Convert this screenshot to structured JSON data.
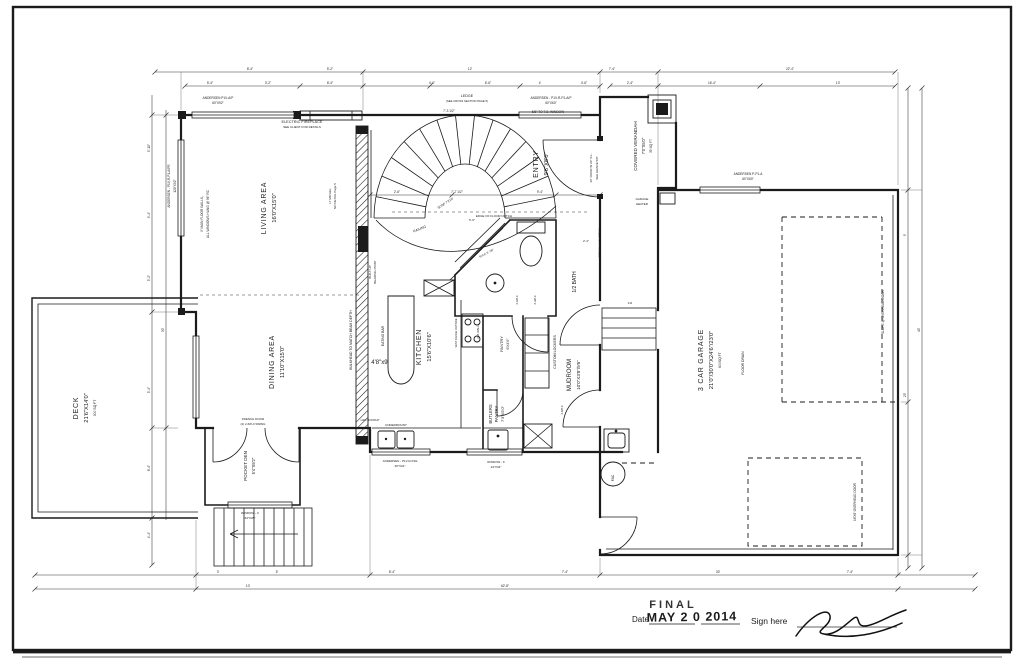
{
  "colors": {
    "ink": "#1b1b1b",
    "dim": "#333333",
    "paper": "#ffffff",
    "scan_shadow": "#b5b5b5"
  },
  "stamp": {
    "date_label": "Date",
    "final": "FINAL",
    "date_stamp": "MAY 2 0 2014",
    "sign_label": "Sign here"
  },
  "labels": [
    {
      "t": "LIVING AREA",
      "x": 266,
      "y": 208,
      "r": -90,
      "s": 7,
      "ls": 0.8,
      "n": "label-living-area"
    },
    {
      "t": "16'0\"X15'0\"",
      "x": 276,
      "y": 208,
      "r": -90,
      "s": 5.8,
      "n": "label-living-area-dims"
    },
    {
      "t": "DINING AREA",
      "x": 274,
      "y": 362,
      "r": -90,
      "s": 7,
      "ls": 0.8,
      "n": "label-dining-area"
    },
    {
      "t": "11'10\"X15'0\"",
      "x": 284,
      "y": 362,
      "r": -90,
      "s": 5.8,
      "n": "label-dining-area-dims"
    },
    {
      "t": "KITCHEN",
      "x": 421,
      "y": 347,
      "r": -90,
      "s": 7,
      "ls": 0.8,
      "n": "label-kitchen"
    },
    {
      "t": "15'6\"X10'6\"",
      "x": 431,
      "y": 347,
      "r": -90,
      "s": 5.8,
      "n": "label-kitchen-dims"
    },
    {
      "t": "ENTRY",
      "x": 538,
      "y": 164,
      "r": -90,
      "s": 7,
      "ls": 0.8,
      "n": "label-entry"
    },
    {
      "t": "9'6\"X8'0\"",
      "x": 548,
      "y": 164,
      "r": -90,
      "s": 5.8,
      "n": "label-entry-dims"
    },
    {
      "t": "DECK",
      "x": 78,
      "y": 408,
      "r": -90,
      "s": 7,
      "ls": 0.8,
      "n": "label-deck"
    },
    {
      "t": "21'6\"X14'0\"",
      "x": 88,
      "y": 408,
      "r": -90,
      "s": 5.8,
      "n": "label-deck-dims"
    },
    {
      "t": "300 SQ FT",
      "x": 96,
      "y": 408,
      "r": -90,
      "s": 3.4,
      "n": "label-deck-area"
    },
    {
      "t": "POCKET DEN",
      "x": 247,
      "y": 466,
      "r": -90,
      "s": 4.6,
      "n": "label-pocket-den"
    },
    {
      "t": "5'4\"X9'2\"",
      "x": 255,
      "y": 466,
      "r": -90,
      "s": 4.2,
      "n": "label-pocket-den-dims"
    },
    {
      "t": "3 CAR GARAGE",
      "x": 703,
      "y": 360,
      "r": -90,
      "s": 7,
      "ls": 0.8,
      "n": "label-garage"
    },
    {
      "t": "21'0\"/30'0\"X24'6\"/23'0\"",
      "x": 713,
      "y": 360,
      "r": -90,
      "s": 5.8,
      "n": "label-garage-dims"
    },
    {
      "t": "600SQ FT",
      "x": 721,
      "y": 360,
      "r": -90,
      "s": 3.4,
      "n": "label-garage-area"
    },
    {
      "t": "MUDROOM",
      "x": 571,
      "y": 375,
      "r": -90,
      "s": 6,
      "n": "label-mudroom"
    },
    {
      "t": "10'0\"X3'8\"/5'6\"",
      "x": 580,
      "y": 375,
      "r": -90,
      "s": 4.6,
      "n": "label-mudroom-dims"
    },
    {
      "t": "BUTLERS",
      "x": 492,
      "y": 414,
      "r": -90,
      "s": 4.2,
      "n": "label-butlers-pantry"
    },
    {
      "t": "PANTRY",
      "x": 498,
      "y": 414,
      "r": -90,
      "s": 4.2,
      "n": "label-butlers-pantry-2"
    },
    {
      "t": "7'3\"X5'0\"",
      "x": 504,
      "y": 414,
      "r": -90,
      "s": 4,
      "n": "label-butlers-pantry-dims"
    },
    {
      "t": "1/2 BATH",
      "x": 576,
      "y": 282,
      "r": -90,
      "s": 5,
      "n": "label-half-bath"
    },
    {
      "t": "COVERED VERANDAH",
      "x": 637,
      "y": 146,
      "r": -90,
      "s": 4.6,
      "n": "label-verandah"
    },
    {
      "t": "7'0\"X5'0\"",
      "x": 645,
      "y": 146,
      "r": -90,
      "s": 4.2,
      "n": "label-verandah-dims"
    },
    {
      "t": "35 SQ FT",
      "x": 652,
      "y": 146,
      "r": -90,
      "s": 3.2,
      "n": "label-verandah-area"
    },
    {
      "t": "PANTRY",
      "x": 503,
      "y": 344,
      "r": -90,
      "s": 4,
      "n": "label-pantry"
    },
    {
      "t": "6'X4'0\"",
      "x": 509,
      "y": 344,
      "r": -90,
      "s": 3.6,
      "n": "label-pantry-dims"
    },
    {
      "t": "CUSTOM LOCKERS",
      "x": 556,
      "y": 352,
      "r": -90,
      "s": 3.6,
      "n": "label-custom-lockers"
    },
    {
      "t": "EATING BAR",
      "x": 384,
      "y": 336,
      "r": -90,
      "s": 3.4,
      "n": "label-eating-bar"
    },
    {
      "t": "4'8\"x9'",
      "x": 380,
      "y": 364,
      "s": 6,
      "n": "label-island-dims"
    },
    {
      "t": "ELECTRIC FIREPLACE",
      "x": 302,
      "y": 123,
      "s": 3.8,
      "n": "note-electric-fireplace"
    },
    {
      "t": "SEE CLIENT FOR DETAILS",
      "x": 302,
      "y": 128,
      "s": 3,
      "n": "note-electric-fireplace-2"
    },
    {
      "t": "LEDGE",
      "x": 467,
      "y": 97,
      "s": 3.6,
      "n": "note-ledge"
    },
    {
      "t": "(SEE CROSS SECTION PAGE 5)",
      "x": 467,
      "y": 102,
      "s": 2.8,
      "n": "note-ledge-2"
    },
    {
      "t": "ANDERSEN P1V-A/P",
      "x": 218,
      "y": 99,
      "s": 3.2,
      "n": "note-window-living"
    },
    {
      "t": "60\"X92\"",
      "x": 218,
      "y": 104,
      "s": 3.2,
      "n": "note-window-living-2"
    },
    {
      "t": "ANDERSEN - P1V-R-P1-A/P",
      "x": 551,
      "y": 99,
      "s": 3.2,
      "n": "note-window-entry"
    },
    {
      "t": "60\"X60\"",
      "x": 551,
      "y": 104,
      "s": 3.2,
      "n": "note-window-entry-2"
    },
    {
      "t": "5/8\" TO T.O. WINDOW",
      "x": 548,
      "y": 113,
      "s": 3.2,
      "n": "note-window-head"
    },
    {
      "t": "ANDERSEN P-P1-A",
      "x": 748,
      "y": 175,
      "s": 3.2,
      "n": "note-window-garage"
    },
    {
      "t": "60\"X60\"",
      "x": 748,
      "y": 180,
      "s": 3.2,
      "n": "note-window-garage-2"
    },
    {
      "t": "ANDERSEN - P1V-R-P1-A/PR",
      "x": 170,
      "y": 186,
      "r": -90,
      "s": 3.2,
      "n": "note-window-left"
    },
    {
      "t": "120\"X92\"",
      "x": 176,
      "y": 186,
      "r": -90,
      "s": 3.2,
      "n": "note-window-left-2"
    },
    {
      "t": "9' MAIN FLOOR WALLS,",
      "x": 203,
      "y": 214,
      "r": -90,
      "s": 3.2,
      "n": "note-wall-height"
    },
    {
      "t": "ALL WINDOWS HUNG @ 96\" RC",
      "x": 209,
      "y": 214,
      "r": -90,
      "s": 3.2,
      "n": "note-wall-height-2"
    },
    {
      "t": "BULKHEAD TO MATCH BEAM DEPTH",
      "x": 352,
      "y": 340,
      "r": -90,
      "s": 3.4,
      "n": "note-bulkhead"
    },
    {
      "t": "LT MICHEL",
      "x": 331,
      "y": 196,
      "r": -90,
      "s": 3,
      "n": "note-lt-michel"
    },
    {
      "t": "NO DETAIL Page 5",
      "x": 336,
      "y": 196,
      "r": -90,
      "s": 3,
      "n": "note-lt-michel-2"
    },
    {
      "t": "BUILT-UP",
      "x": 371,
      "y": 272,
      "r": -90,
      "s": 3,
      "n": "note-bearing-point"
    },
    {
      "t": "BEARING POINT",
      "x": 376,
      "y": 272,
      "r": -90,
      "s": 3,
      "n": "note-bearing-point-2"
    },
    {
      "t": "EDGE OF FLOOR NOTCH",
      "x": 494,
      "y": 217,
      "s": 3,
      "n": "note-floor-notch"
    },
    {
      "t": "RAILING",
      "x": 420,
      "y": 230,
      "r": -22,
      "s": 3.4,
      "n": "note-railing"
    },
    {
      "t": "SUSP 7'X10'",
      "x": 446,
      "y": 204,
      "r": -33,
      "s": 3.2,
      "n": "note-susp"
    },
    {
      "t": "13\"WALL LVL BEAM",
      "x": 601,
      "y": 243,
      "r": -90,
      "s": 3.2,
      "n": "note-lvl-beam"
    },
    {
      "t": "36\" DOOR W 20\" S.L.",
      "x": 592,
      "y": 168,
      "r": -90,
      "s": 3,
      "n": "note-front-door"
    },
    {
      "t": "SEE GRADE 5/8\"",
      "x": 598,
      "y": 168,
      "r": -90,
      "s": 3,
      "n": "note-front-door-2"
    },
    {
      "t": "GARAGE",
      "x": 642,
      "y": 200,
      "s": 3,
      "n": "note-garage-heater"
    },
    {
      "t": "HEATER",
      "x": 642,
      "y": 205,
      "s": 3,
      "n": "note-garage-heater-2"
    },
    {
      "t": "FLOOR DRAIN",
      "x": 744,
      "y": 363,
      "r": -90,
      "s": 3.4,
      "n": "note-floor-drain"
    },
    {
      "t": "SLOPE @ OVERHEAD DOOR",
      "x": 884,
      "y": 312,
      "r": -90,
      "s": 3.2,
      "n": "note-slope-ohd"
    },
    {
      "t": "16'X8' OVERHEAD DOOR",
      "x": 856,
      "y": 502,
      "r": -90,
      "s": 3.2,
      "n": "note-overhead-door"
    },
    {
      "t": "FRENCH DOOR",
      "x": 253,
      "y": 420,
      "s": 3,
      "n": "note-french-door"
    },
    {
      "t": "(2) 2-6/8-0 SWING",
      "x": 253,
      "y": 425,
      "s": 3,
      "n": "note-french-door-2"
    },
    {
      "t": "WINDOW - C",
      "x": 250,
      "y": 514,
      "s": 3,
      "n": "note-window-c"
    },
    {
      "t": "64\"X28\"",
      "x": 250,
      "y": 519,
      "s": 3,
      "n": "note-window-c-2"
    },
    {
      "t": "WINDOW - K",
      "x": 496,
      "y": 463,
      "s": 3,
      "n": "note-window-k"
    },
    {
      "t": "24\"X34\"",
      "x": 496,
      "y": 468,
      "s": 3,
      "n": "note-window-k-2"
    },
    {
      "t": "ANDERSEN - P1V-R-P1E",
      "x": 400,
      "y": 462,
      "s": 3,
      "n": "note-window-kitchen"
    },
    {
      "t": "60\"X24\"",
      "x": 400,
      "y": 467,
      "s": 3,
      "n": "note-window-kitchen-2"
    },
    {
      "t": "UNDERMOUNT",
      "x": 396,
      "y": 426,
      "s": 3,
      "n": "note-undermount"
    },
    {
      "t": "H2O HOOKUP",
      "x": 370,
      "y": 421,
      "s": 2.8,
      "n": "note-h2o"
    },
    {
      "t": "FAC",
      "x": 614,
      "y": 478,
      "r": -90,
      "s": 3.4,
      "n": "note-fac"
    },
    {
      "t": "2X6 WALL",
      "x": 479,
      "y": 332,
      "r": -90,
      "s": 2.8,
      "n": "note-2x6-wall"
    },
    {
      "t": "VENT RANGE OUTSIDE",
      "x": 457,
      "y": 333,
      "r": -90,
      "s": 2.6,
      "n": "note-vent-range"
    },
    {
      "t": "BULK 5'-7/8\"",
      "x": 487,
      "y": 254,
      "r": -28,
      "s": 2.8,
      "n": "note-bulk"
    },
    {
      "t": "8'-4\"",
      "x": 250,
      "y": 70,
      "s": 3.2
    },
    {
      "t": "5'-2\"",
      "x": 330,
      "y": 70,
      "s": 3.2
    },
    {
      "t": "12'",
      "x": 470,
      "y": 70,
      "s": 3.2
    },
    {
      "t": "7'-4\"",
      "x": 612,
      "y": 70,
      "s": 3.2
    },
    {
      "t": "22'-4\"",
      "x": 790,
      "y": 70,
      "s": 3.2
    },
    {
      "t": "5'-4\"",
      "x": 210,
      "y": 84,
      "s": 3.2
    },
    {
      "t": "3'-2\"",
      "x": 268,
      "y": 84,
      "s": 3.2
    },
    {
      "t": "8'-4\"",
      "x": 330,
      "y": 84,
      "s": 3.2
    },
    {
      "t": "4'-6\"",
      "x": 432,
      "y": 84,
      "s": 3.2
    },
    {
      "t": "6'-6\"",
      "x": 488,
      "y": 84,
      "s": 3.2
    },
    {
      "t": "4'",
      "x": 540,
      "y": 84,
      "s": 3.2
    },
    {
      "t": "4'-6\"",
      "x": 584,
      "y": 84,
      "s": 3.2
    },
    {
      "t": "2'-4\"",
      "x": 630,
      "y": 84,
      "s": 3.2
    },
    {
      "t": "16'-4\"",
      "x": 712,
      "y": 84,
      "s": 3.2
    },
    {
      "t": "13'",
      "x": 838,
      "y": 84,
      "s": 3.2
    },
    {
      "t": "3'",
      "x": 218,
      "y": 573,
      "s": 3.2
    },
    {
      "t": "5'",
      "x": 277,
      "y": 573,
      "s": 3.2
    },
    {
      "t": "8'-4\"",
      "x": 392,
      "y": 573,
      "s": 3.2
    },
    {
      "t": "7'-4\"",
      "x": 565,
      "y": 573,
      "s": 3.2
    },
    {
      "t": "30'",
      "x": 718,
      "y": 573,
      "s": 3.2
    },
    {
      "t": "7'-4\"",
      "x": 850,
      "y": 573,
      "s": 3.2
    },
    {
      "t": "10'",
      "x": 248,
      "y": 587,
      "s": 3.2
    },
    {
      "t": "62'-8\"",
      "x": 505,
      "y": 587,
      "s": 3.2
    },
    {
      "t": "5'-10\"",
      "x": 150,
      "y": 148,
      "r": -90,
      "s": 3.2
    },
    {
      "t": "9'-4\"",
      "x": 150,
      "y": 215,
      "r": -90,
      "s": 3.2
    },
    {
      "t": "5'-2\"",
      "x": 150,
      "y": 278,
      "r": -90,
      "s": 3.2
    },
    {
      "t": "30'",
      "x": 164,
      "y": 330,
      "r": -90,
      "s": 3.2
    },
    {
      "t": "5'-4\"",
      "x": 150,
      "y": 390,
      "r": -90,
      "s": 3.2
    },
    {
      "t": "8'-4\"",
      "x": 150,
      "y": 468,
      "r": -90,
      "s": 3.2
    },
    {
      "t": "4'-4\"",
      "x": 150,
      "y": 535,
      "r": -90,
      "s": 3.2
    },
    {
      "t": "9'",
      "x": 906,
      "y": 235,
      "r": -90,
      "s": 3.2
    },
    {
      "t": "23'",
      "x": 906,
      "y": 395,
      "r": -90,
      "s": 3.2
    },
    {
      "t": "40'",
      "x": 920,
      "y": 330,
      "r": -90,
      "s": 3.2
    },
    {
      "t": "2'-6\"",
      "x": 397,
      "y": 193,
      "s": 3.2
    },
    {
      "t": "7'-7 1/2\"",
      "x": 457,
      "y": 193,
      "s": 3.2
    },
    {
      "t": "9'-4\"",
      "x": 540,
      "y": 193,
      "s": 3.2
    },
    {
      "t": "7'-3 1/2\"",
      "x": 449,
      "y": 112,
      "s": 3.2
    },
    {
      "t": "5'-6\"",
      "x": 472,
      "y": 221,
      "s": 3
    },
    {
      "t": "2'-4\"",
      "x": 586,
      "y": 242,
      "s": 3
    },
    {
      "t": "2-6/8-0",
      "x": 518,
      "y": 300,
      "r": -90,
      "s": 2.8
    },
    {
      "t": "2-4/8-0",
      "x": 536,
      "y": 300,
      "r": -90,
      "s": 2.8
    },
    {
      "t": "2-8/8-0",
      "x": 563,
      "y": 410,
      "r": -90,
      "s": 2.8
    },
    {
      "t": "3-R",
      "x": 630,
      "y": 304,
      "s": 2.8
    }
  ]
}
